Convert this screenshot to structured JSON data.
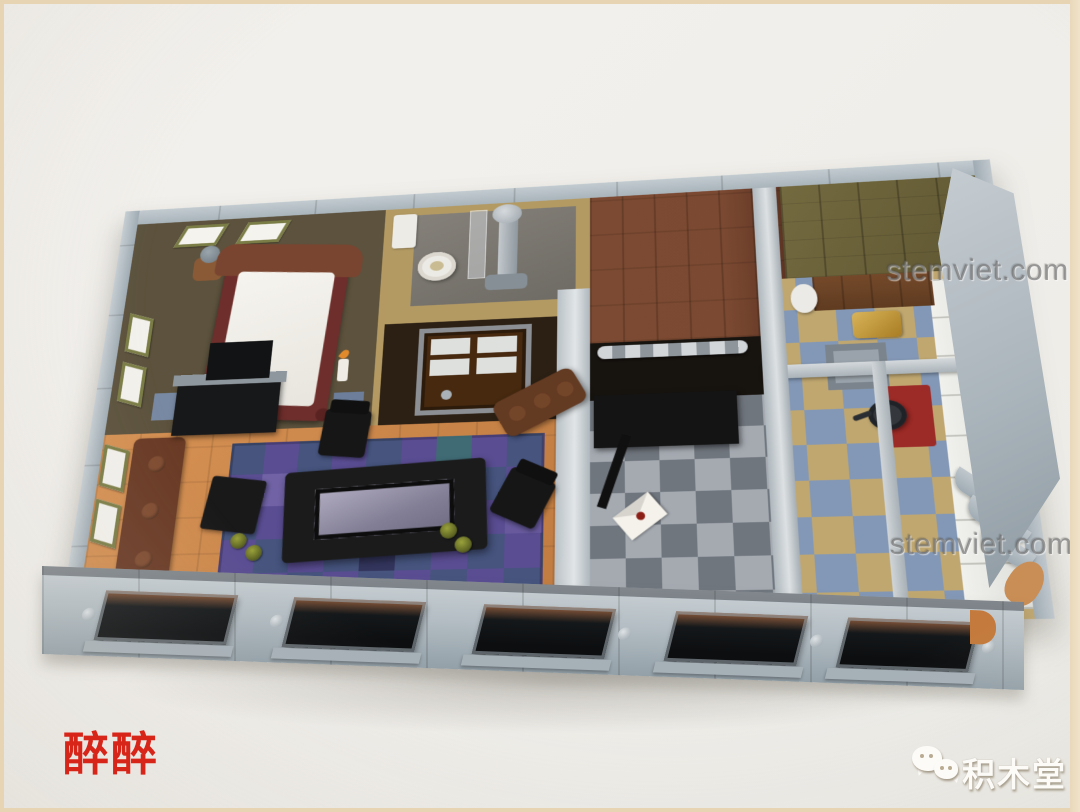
{
  "scene": {
    "description": "Top-down photograph of a LEGO modular building interior floor displayed on a white table",
    "background_color": "#f1efeb",
    "frame_color": "#e7d4b2"
  },
  "watermarks": {
    "stemviet_upper": {
      "text": "stemviet.com",
      "color": "#696969"
    },
    "stemviet_lower": {
      "text": "stemviet.com",
      "color": "#696969"
    },
    "red_stamp": {
      "text": "醉醉",
      "color": "#d8251a"
    },
    "brand": {
      "text": "积木堂",
      "color": "#fcfbf8",
      "icon": "wechat-icon"
    }
  },
  "palette": {
    "lego_light_gray": "#aeb9bf",
    "olive_wall": "#6b5e45",
    "tan_wall": "#b39a63",
    "brown_platform": "#7c4a32",
    "plank_olive": "#6b6139",
    "kitchen_blue_tile": "#8398b6",
    "kitchen_tan_tile": "#c0a770",
    "checker_light_gray": "#a5aab1",
    "checker_dark_gray": "#70767e",
    "floor_orange": "#cf8a4c",
    "tile_purple": "#5a4d92",
    "tile_blue": "#46547e",
    "bed_dark_red": "#6e2e2b",
    "stove_red": "#9c2a26",
    "brass_gold": "#b98a2e"
  }
}
